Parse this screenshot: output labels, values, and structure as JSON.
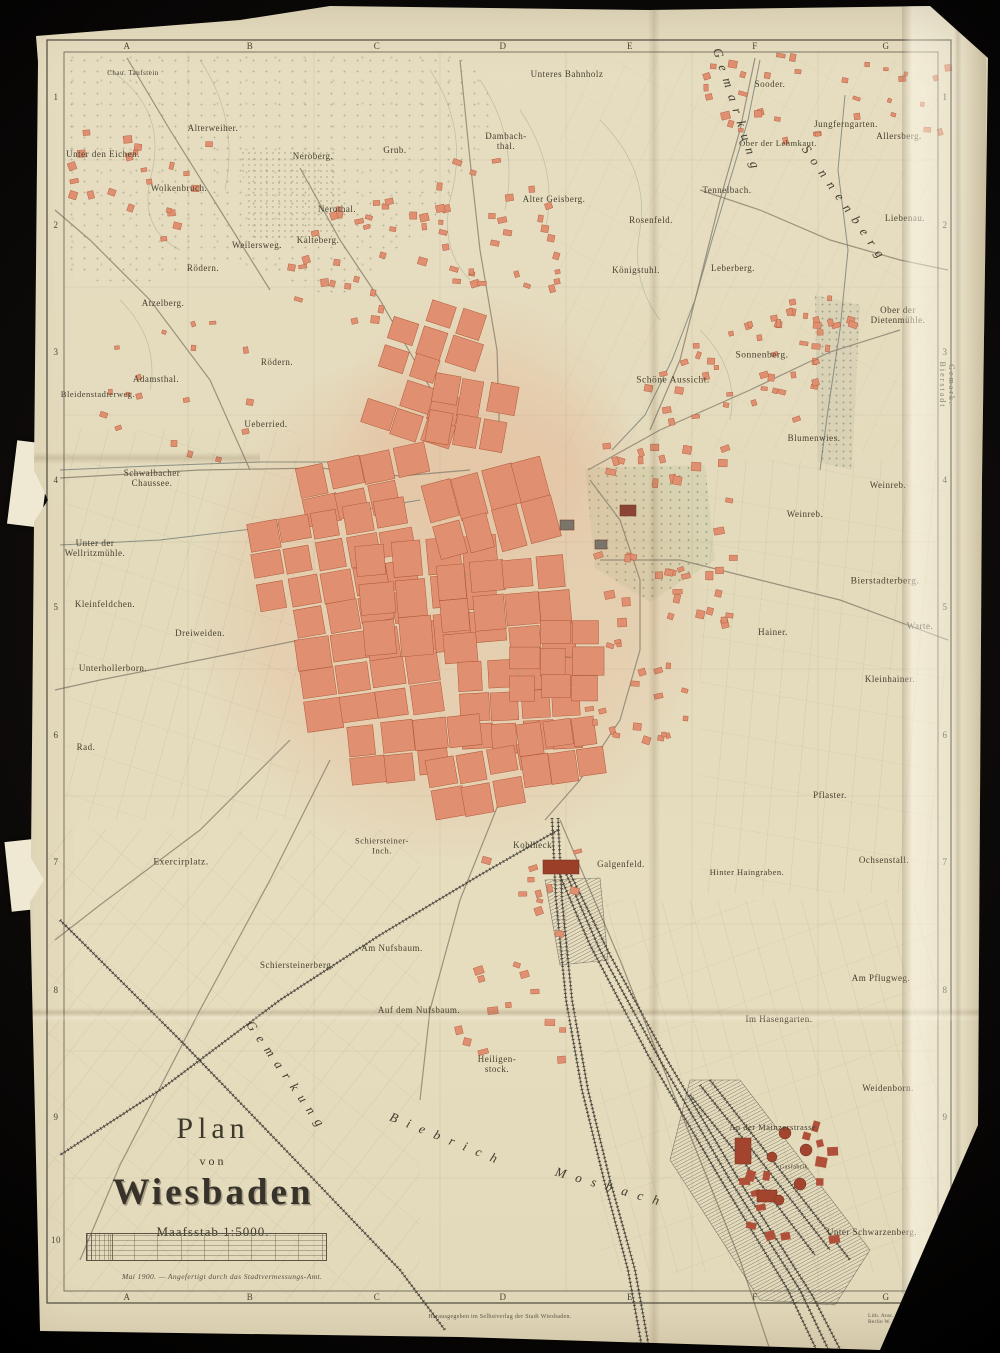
{
  "title_block": {
    "plan": "Plan",
    "von": "von",
    "city": "Wiesbaden",
    "scale_label": "Maafsstab  1:5000.",
    "note": "Mai 1900. — Angefertigt durch das Stadtvermessungs-Amt."
  },
  "footer": {
    "center": "Herausgegeben im Selbstverlag der Stadt Wiesbaden.",
    "right": "Lith. Anst. v. Bogdan Gisevius, Berlin W. Linkstr. 29."
  },
  "grid": {
    "columns": [
      "A",
      "B",
      "C",
      "D",
      "E",
      "F",
      "G"
    ],
    "rows": [
      "1",
      "2",
      "3",
      "4",
      "5",
      "6",
      "7",
      "8",
      "9",
      "10"
    ],
    "col_x": [
      127,
      250,
      377,
      503,
      630,
      755,
      886
    ],
    "row_y": [
      97,
      225,
      352,
      480,
      607,
      735,
      862,
      990,
      1117,
      1240
    ],
    "top_y": 46,
    "bottom_y": 1297,
    "left_x": 56,
    "right_x": 945
  },
  "colors": {
    "paper": "#e6dcbe",
    "block_fill": "#e09070",
    "block_stroke": "#ad5638",
    "road": "#8d8472",
    "stream": "#78827a",
    "rail": "#3e3b34",
    "frame": "#4e4a3e",
    "label": "#45412f",
    "industry": "#a3452e"
  },
  "labels": [
    {
      "t": "Chau. Taufstein",
      "x": 133,
      "y": 74,
      "s": 7
    },
    {
      "t": "Alterweiher.",
      "x": 213,
      "y": 128,
      "s": 9
    },
    {
      "t": "Unter den Eichen.",
      "x": 103,
      "y": 154,
      "s": 9
    },
    {
      "t": "Neroberg.",
      "x": 313,
      "y": 156,
      "s": 9
    },
    {
      "t": "Grub.",
      "x": 395,
      "y": 150,
      "s": 9
    },
    {
      "t": "Dambach-\nthal.",
      "x": 506,
      "y": 141,
      "s": 9
    },
    {
      "t": "Unteres Bahnholz",
      "x": 567,
      "y": 74,
      "s": 9
    },
    {
      "t": "Sooder.",
      "x": 770,
      "y": 84,
      "s": 9
    },
    {
      "t": "Jungferngarten.",
      "x": 846,
      "y": 124,
      "s": 9
    },
    {
      "t": "Allersberg.",
      "x": 899,
      "y": 136,
      "s": 9
    },
    {
      "t": "Ober der Lehmkaut.",
      "x": 778,
      "y": 144,
      "s": 8.5
    },
    {
      "t": "Wolkenbruch.",
      "x": 179,
      "y": 188,
      "s": 9
    },
    {
      "t": "Alter Geisberg.",
      "x": 554,
      "y": 199,
      "s": 9
    },
    {
      "t": "Tennelbach.",
      "x": 727,
      "y": 190,
      "s": 9
    },
    {
      "t": "Rosenfeld.",
      "x": 651,
      "y": 220,
      "s": 9
    },
    {
      "t": "Liebenau.",
      "x": 905,
      "y": 218,
      "s": 9
    },
    {
      "t": "Nerothal.",
      "x": 337,
      "y": 209,
      "s": 9
    },
    {
      "t": "Weilersweg.",
      "x": 257,
      "y": 245,
      "s": 9
    },
    {
      "t": "Kalteberg.",
      "x": 318,
      "y": 240,
      "s": 9
    },
    {
      "t": "Rödern.",
      "x": 203,
      "y": 268,
      "s": 9
    },
    {
      "t": "Königstuhl.",
      "x": 636,
      "y": 270,
      "s": 9
    },
    {
      "t": "Leberberg.",
      "x": 733,
      "y": 268,
      "s": 9
    },
    {
      "t": "Ober der\nDietenmühle.",
      "x": 898,
      "y": 315,
      "s": 9
    },
    {
      "t": "Atzelberg.",
      "x": 163,
      "y": 303,
      "s": 9
    },
    {
      "t": "Rödern.",
      "x": 277,
      "y": 362,
      "s": 9
    },
    {
      "t": "Adamsthal.",
      "x": 156,
      "y": 379,
      "s": 9
    },
    {
      "t": "Bleidenstadterweg.",
      "x": 98,
      "y": 395,
      "s": 8.5
    },
    {
      "t": "Sonnenberg.",
      "x": 762,
      "y": 356,
      "s": 9.5
    },
    {
      "t": "Schöne Aussicht.",
      "x": 673,
      "y": 381,
      "s": 9.5
    },
    {
      "t": "Ueberried.",
      "x": 266,
      "y": 424,
      "s": 9
    },
    {
      "t": "Blumenwies.",
      "x": 814,
      "y": 438,
      "s": 9
    },
    {
      "t": "Gemark.  Bierstadt",
      "x": 946,
      "y": 385,
      "s": 8,
      "r": 90,
      "ls": 2
    },
    {
      "t": "Schwalbacher\nChaussee.",
      "x": 152,
      "y": 478,
      "s": 9
    },
    {
      "t": "Weinreb.",
      "x": 888,
      "y": 485,
      "s": 9
    },
    {
      "t": "Weinreb.",
      "x": 805,
      "y": 514,
      "s": 9
    },
    {
      "t": "Unter der\nWellritzmühle.",
      "x": 95,
      "y": 548,
      "s": 9
    },
    {
      "t": "Bierstadterberg.",
      "x": 885,
      "y": 582,
      "s": 9.5
    },
    {
      "t": "Kleinfeldchen.",
      "x": 105,
      "y": 604,
      "s": 9
    },
    {
      "t": "Dreiweiden.",
      "x": 200,
      "y": 633,
      "s": 9
    },
    {
      "t": "Warte.",
      "x": 920,
      "y": 626,
      "s": 9
    },
    {
      "t": "Hainer.",
      "x": 773,
      "y": 632,
      "s": 9
    },
    {
      "t": "Unterhollerborn.",
      "x": 113,
      "y": 668,
      "s": 9
    },
    {
      "t": "Kleinhainer.",
      "x": 890,
      "y": 679,
      "s": 9
    },
    {
      "t": "Rad.",
      "x": 86,
      "y": 747,
      "s": 9
    },
    {
      "t": "Pflaster.",
      "x": 830,
      "y": 795,
      "s": 9
    },
    {
      "t": "Schiersteiner-\nInch.",
      "x": 382,
      "y": 846,
      "s": 8.5
    },
    {
      "t": "Kohlheck.",
      "x": 534,
      "y": 845,
      "s": 9
    },
    {
      "t": "Galgenfeld.",
      "x": 621,
      "y": 864,
      "s": 9
    },
    {
      "t": "Hinter Haingraben.",
      "x": 747,
      "y": 873,
      "s": 8.5
    },
    {
      "t": "Ochsenstall.",
      "x": 884,
      "y": 860,
      "s": 9
    },
    {
      "t": "Exercirplatz.",
      "x": 181,
      "y": 863,
      "s": 9.5
    },
    {
      "t": "Am Nufsbaum.",
      "x": 392,
      "y": 948,
      "s": 9
    },
    {
      "t": "Schiersteinerberg.",
      "x": 297,
      "y": 965,
      "s": 9
    },
    {
      "t": "Auf dem Nufsbaum.",
      "x": 419,
      "y": 1010,
      "s": 9
    },
    {
      "t": "Am Pflugweg.",
      "x": 881,
      "y": 978,
      "s": 9
    },
    {
      "t": "Im Hasengarten.",
      "x": 779,
      "y": 1019,
      "s": 9
    },
    {
      "t": "Heiligen-\nstock.",
      "x": 497,
      "y": 1064,
      "s": 9
    },
    {
      "t": "Weidenborn.",
      "x": 888,
      "y": 1088,
      "s": 9
    },
    {
      "t": "An der Mainzerstrasse.",
      "x": 774,
      "y": 1128,
      "s": 8.5
    },
    {
      "t": "Gasfabrik.",
      "x": 795,
      "y": 1168,
      "s": 6
    },
    {
      "t": "Unter Schwarzenberg.",
      "x": 872,
      "y": 1232,
      "s": 9
    },
    {
      "t": "Gemarkung",
      "x": 287,
      "y": 1077,
      "s": 13,
      "r": 55,
      "ls": 8,
      "i": 1
    },
    {
      "t": "Biebrich",
      "x": 448,
      "y": 1140,
      "s": 13,
      "r": 22,
      "ls": 10,
      "i": 1
    },
    {
      "t": "Mosbach",
      "x": 612,
      "y": 1188,
      "s": 13,
      "r": 16,
      "ls": 10,
      "i": 1
    },
    {
      "t": "Gemarkung",
      "x": 737,
      "y": 112,
      "s": 13,
      "r": 72,
      "ls": 8,
      "i": 1
    },
    {
      "t": "Sonnenberg",
      "x": 845,
      "y": 205,
      "s": 13,
      "r": 55,
      "ls": 8,
      "i": 1
    }
  ],
  "map_geometry": {
    "frame": {
      "outer": [
        47,
        40,
        904,
        1263
      ],
      "inner": [
        64,
        52,
        874,
        1239
      ]
    },
    "gridlines": {
      "vx": [
        188,
        314,
        440,
        566,
        692,
        818
      ],
      "hy": [
        160,
        287,
        415,
        542,
        669,
        796,
        924,
        1051,
        1178
      ]
    },
    "contours": [
      "M110,70 Q170,110 150,180 Q140,230 180,250",
      "M200,60 Q240,120 225,190",
      "M430,70 Q470,130 450,200 Q440,250 470,280",
      "M480,80 Q520,140 505,210",
      "M520,110 Q560,170 545,230",
      "M600,120 Q650,170 640,230 Q630,280 660,320",
      "M700,330 Q740,370 730,420",
      "M120,300 Q160,340 150,390"
    ],
    "streams": [
      "845,95 838,170 848,250 840,330 828,410 820,470",
      "760,60 748,120 730,180 712,240 695,300 672,360 645,415 612,450",
      "60,545 160,540 260,528 350,512 420,500",
      "60,470 150,466 260,462 340,462"
    ],
    "roads": [
      "60,478 200,470 320,468 400,476 470,470",
      "300,168 340,240 380,300 420,370 460,440",
      "460,60 470,160 480,250 497,350 500,450",
      "588,470 660,430 750,390 830,352 900,330",
      "600,560 680,560 760,580 840,600 948,640",
      "300,640 200,660 100,680 55,690",
      "290,740 200,830 100,905 55,940",
      "330,760 270,880 200,1010 120,1165 80,1260",
      "560,820 620,960 680,1110 740,1260 770,1350",
      "500,800 460,900 430,1010 420,1100",
      "250,470 210,380 150,300 90,240 55,210",
      "590,480 620,520 640,580 640,650 620,720 580,780 545,820",
      "700,190 760,210 830,240 900,260 948,270",
      "127,58 170,130 220,210 270,290",
      "755,58 740,130 720,200 700,280 680,360 650,430"
    ],
    "rails": [
      "558,818 562,900 572,1000 588,1090 610,1180 635,1270 650,1353",
      "552,818 556,900 566,1000 582,1090 604,1180 628,1270 643,1353",
      "560,860 600,950 660,1060 730,1180 800,1290 830,1353",
      "566,865 610,955 670,1065 742,1185 812,1295 842,1353",
      "554,862 590,945 648,1055 718,1175 788,1290 818,1353",
      "558,830 480,875 380,935 280,1000 160,1090 60,1155",
      "60,920 180,1040 300,1165 400,1270 445,1330",
      "700,1085 760,1160 830,1250",
      "710,1080 780,1170 850,1260",
      "690,1095 750,1170 815,1255"
    ],
    "yards": [
      "690,1080 740,1080 870,1250 835,1305 760,1300 670,1160",
      "545,880 600,878 608,960 560,965"
    ],
    "clusters": [
      [
        300,
        455,
        130,
        60,
        4,
        2,
        -12
      ],
      [
        255,
        510,
        160,
        120,
        5,
        4,
        -10
      ],
      [
        300,
        630,
        140,
        90,
        4,
        3,
        -8
      ],
      [
        360,
        540,
        140,
        110,
        4,
        3,
        -5
      ],
      [
        430,
        470,
        120,
        80,
        4,
        2,
        -15
      ],
      [
        440,
        560,
        130,
        100,
        4,
        3,
        -5
      ],
      [
        460,
        660,
        120,
        90,
        4,
        3,
        -3
      ],
      [
        350,
        720,
        130,
        60,
        4,
        2,
        -6
      ],
      [
        430,
        750,
        120,
        60,
        4,
        2,
        -10
      ],
      [
        510,
        620,
        90,
        80,
        3,
        3,
        0
      ],
      [
        520,
        720,
        80,
        60,
        3,
        2,
        -8
      ],
      [
        380,
        300,
        90,
        140,
        3,
        5,
        18
      ],
      [
        430,
        380,
        80,
        70,
        3,
        2,
        10
      ]
    ],
    "scatters": [
      [
        390,
        150,
        170,
        140,
        36,
        6
      ],
      [
        280,
        190,
        120,
        130,
        24,
        6
      ],
      [
        590,
        440,
        140,
        190,
        40,
        7
      ],
      [
        640,
        300,
        190,
        130,
        30,
        6
      ],
      [
        760,
        290,
        90,
        100,
        20,
        6
      ],
      [
        690,
        50,
        150,
        90,
        20,
        6
      ],
      [
        60,
        130,
        150,
        130,
        22,
        6
      ],
      [
        580,
        640,
        110,
        110,
        20,
        6
      ],
      [
        450,
        930,
        130,
        140,
        14,
        7
      ],
      [
        720,
        1120,
        110,
        120,
        16,
        8,
        "#b0503a"
      ],
      [
        840,
        60,
        120,
        70,
        14,
        5
      ],
      [
        100,
        320,
        160,
        140,
        18,
        5
      ],
      [
        480,
        850,
        100,
        60,
        10,
        6
      ]
    ],
    "landmarks": {
      "rects": [
        [
          543,
          860,
          36,
          14,
          "#9c3f28"
        ],
        [
          560,
          520,
          14,
          10,
          "#7a756a"
        ],
        [
          595,
          540,
          12,
          9,
          "#7a756a"
        ],
        [
          620,
          505,
          16,
          11,
          "#8a4535"
        ],
        [
          735,
          1138,
          16,
          26,
          "#a3452e"
        ],
        [
          757,
          1190,
          20,
          12,
          "#a3452e"
        ]
      ],
      "circles": [
        [
          785,
          1133,
          6
        ],
        [
          806,
          1150,
          6
        ],
        [
          772,
          1157,
          5
        ],
        [
          800,
          1184,
          6
        ],
        [
          779,
          1200,
          5
        ]
      ]
    }
  }
}
